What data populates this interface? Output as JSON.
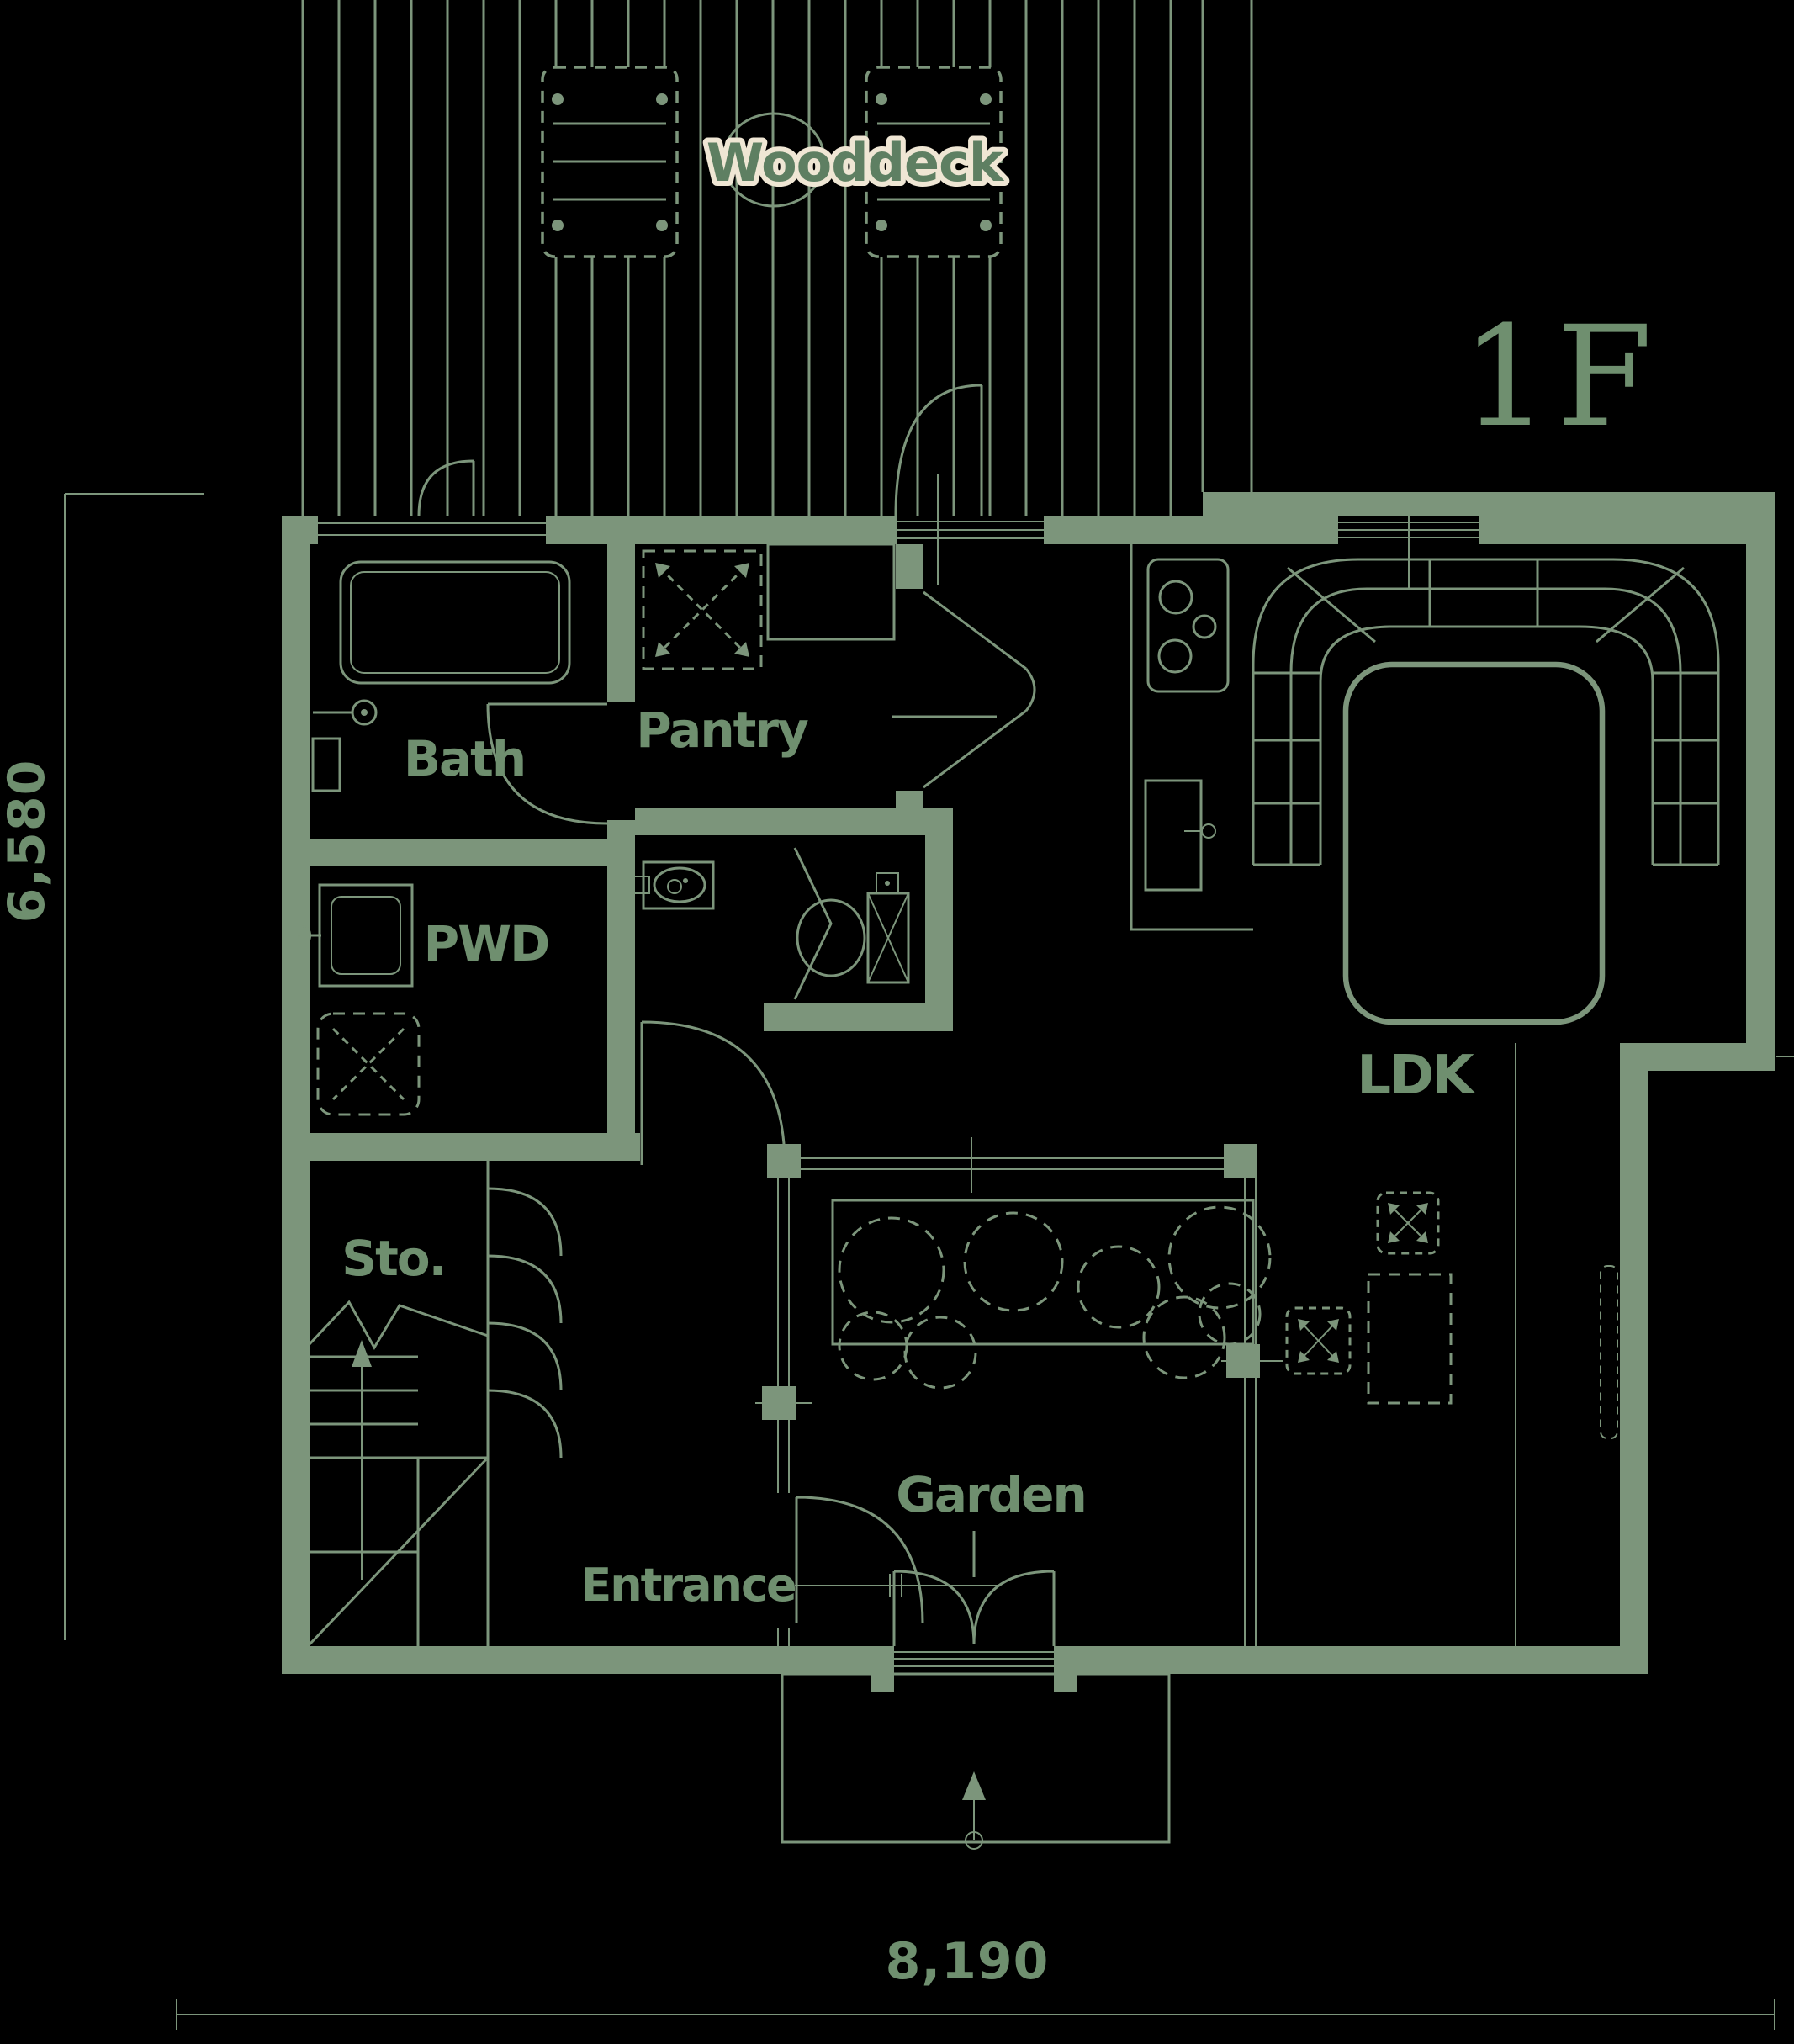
{
  "floor_plan": {
    "floor_label": "1F",
    "rooms": {
      "wooddeck": "Wooddeck",
      "bath": "Bath",
      "pantry": "Pantry",
      "pwd": "PWD",
      "storage": "Sto.",
      "entrance": "Entrance",
      "garden": "Garden",
      "ldk": "LDK"
    },
    "dimensions": {
      "width_mm": "8,190",
      "height_mm": "6,580"
    },
    "colors": {
      "background": "#000000",
      "line_green": "#7C957B",
      "label_green": "#6F8F6F",
      "wooddeck_text_green": "#5E7F62",
      "cream_outline": "#EFE6D4"
    }
  }
}
